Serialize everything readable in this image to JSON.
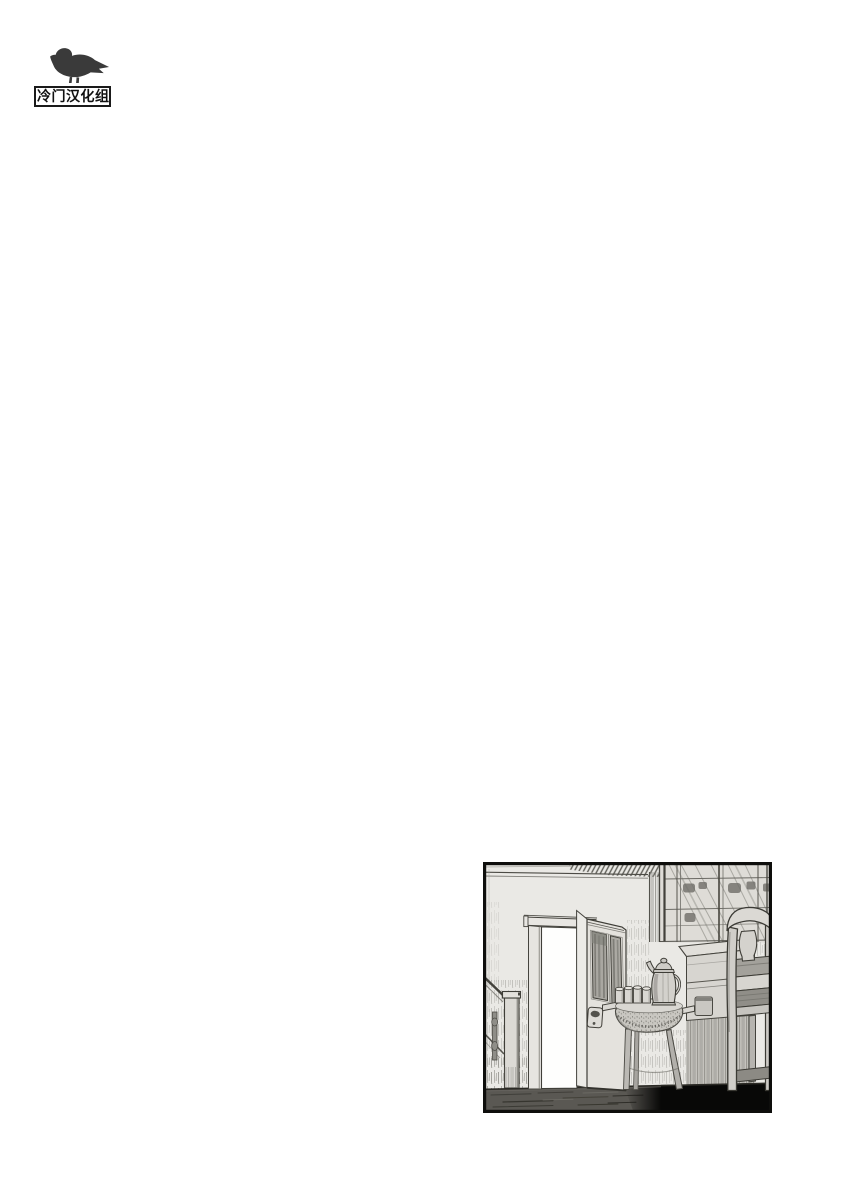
{
  "page": {
    "background": "#ffffff"
  },
  "watermark": {
    "group_name": "冷门汉化组",
    "logo_icon": "pigeon-silhouette",
    "logo_color": "#3a3a3a",
    "box_border_color": "#1a1a1a",
    "box_background": "#ffffff",
    "text_color": "#111111"
  },
  "panel": {
    "kind": "manga-panel",
    "scene": "Empty hallway interior: open paneled door with bright doorway, staircase banister and newel post at left, small round cloth-draped side table holding a coffee pot and four cups, chest of drawers below a glass-front china cabinet, wooden chair at right, dark plank floor sinking into black shadow",
    "border_color": "#0e0e0c",
    "wall_color": "#eae9e5",
    "doorway_color": "#fefefd",
    "floor_color": "#5a5853",
    "shadow_color": "#080807",
    "ink_color": "#3e3d37"
  }
}
